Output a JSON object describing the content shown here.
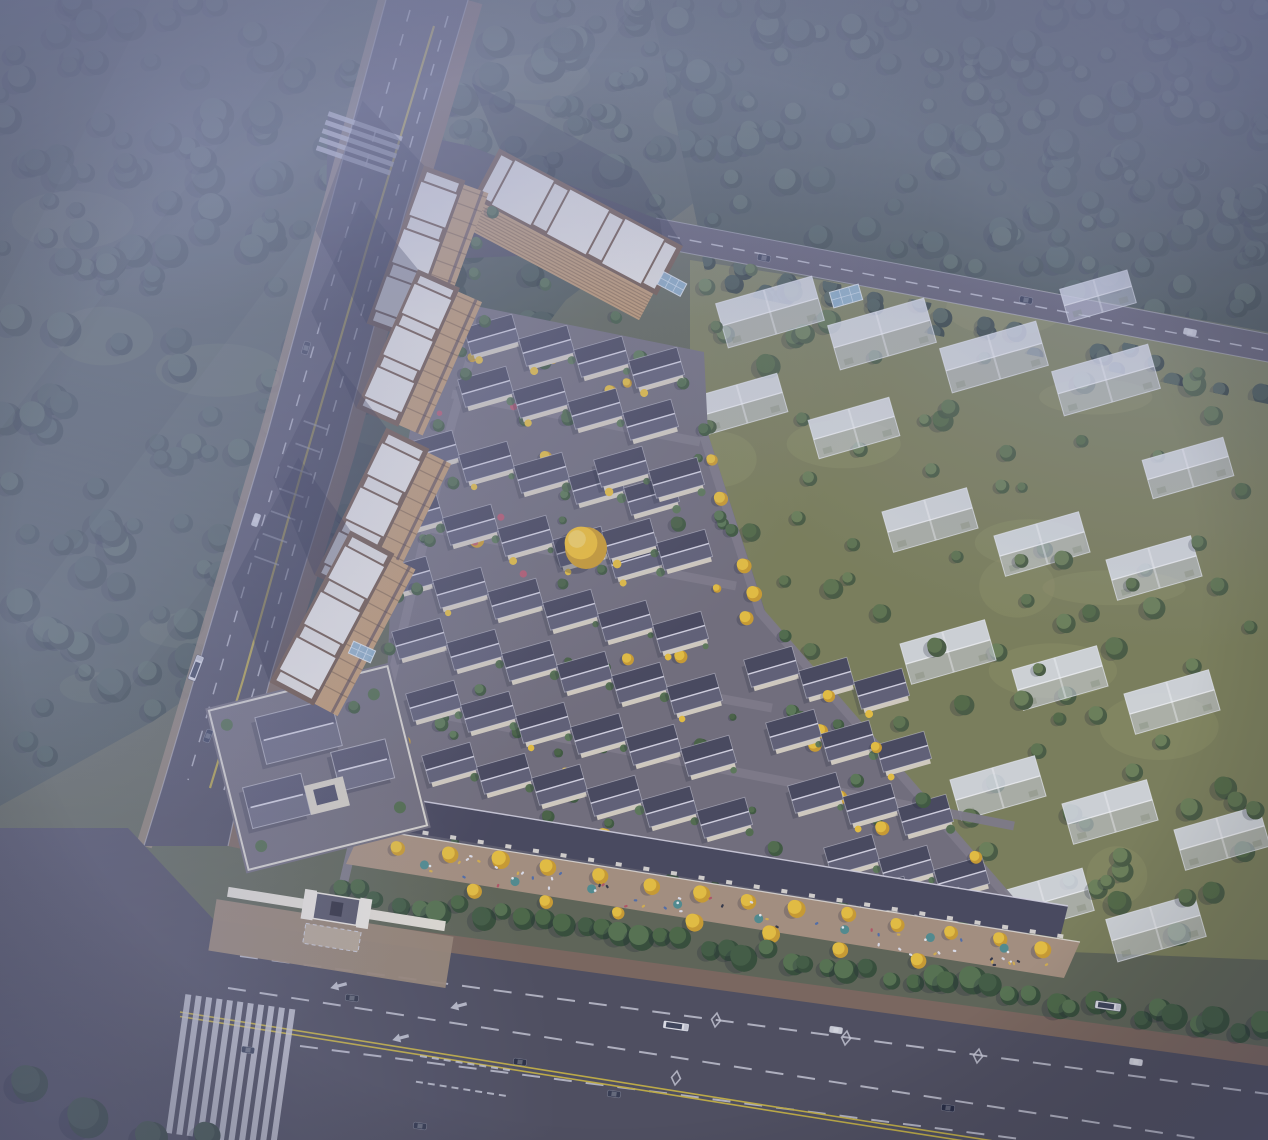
{
  "scene": {
    "canvas": {
      "w": 1268,
      "h": 1140
    },
    "seed": 77,
    "palette": {
      "ground": "#5d6350",
      "grassOlive": "#7b7e54",
      "grassLight": "#8f905f",
      "forestDark": "#32413a",
      "forestMid": "#3e4f45",
      "forestLight": "#4b5d4f",
      "treeGreen": "#4e6a45",
      "treeGreenDk": "#3c5637",
      "hedge": [
        "#3f5a3c",
        "#49663f",
        "#547149"
      ],
      "asphalt": "#4b4a59",
      "asphaltDark": "#45444f",
      "laneWhite": "#cfd0da",
      "laneYellow": "#c3ae3d",
      "sidewalkBrown": "#7b6557",
      "sidewalkTan": "#9a8672",
      "promenade": "#a8907b",
      "villaPaving": "#716d78",
      "pathGray": "#7e7a85",
      "roofDark": "#454457",
      "roofLight": "#5f5e72",
      "ridge": "#d8d6e2",
      "wallCream": "#d9d1c0",
      "towerFacade": "#c49a6a",
      "towerFacadeDk": "#7c5c3c",
      "towerRoof": "#ece9e2",
      "towerParapet": "#6e523e",
      "ghostFill": "rgba(221,224,238,0.52)",
      "ghostRoof": "rgba(238,240,248,0.62)",
      "ghostStroke": "rgba(248,249,253,0.65)",
      "gingko": "#ecc238",
      "gingkoDk": "#d09d27",
      "flowerRed": "#c05468",
      "umbrella": "#4e8c8c",
      "shadow": "rgba(21,24,44,0.36)",
      "fog": "#9aa0c6"
    },
    "forest_regions": [
      {
        "id": "tl",
        "base": "#47534b",
        "poly": [
          [
            0,
            0
          ],
          [
            910,
            0
          ],
          [
            716,
            186
          ],
          [
            566,
            300
          ],
          [
            436,
            468
          ],
          [
            300,
            622
          ],
          [
            152,
            722
          ],
          [
            0,
            806
          ]
        ],
        "count": 250,
        "rmin": 7,
        "rmax": 17
      },
      {
        "id": "ne",
        "base": "#3e4b44",
        "poly": [
          [
            650,
            0
          ],
          [
            1268,
            0
          ],
          [
            1268,
            332
          ],
          [
            698,
            228
          ]
        ],
        "count": 170,
        "rmin": 7,
        "rmax": 15
      },
      {
        "id": "neside",
        "base": "none",
        "poly": [
          [
            702,
            256
          ],
          [
            1268,
            372
          ],
          [
            1268,
            404
          ],
          [
            708,
            288
          ]
        ],
        "count": 30,
        "rmin": 7,
        "rmax": 11
      }
    ],
    "clearings": {
      "count": 9
    },
    "light_beams": [
      [
        [
          150,
          0
        ],
        [
          330,
          0
        ],
        [
          0,
          430
        ],
        [
          0,
          300
        ]
      ],
      [
        [
          480,
          0
        ],
        [
          640,
          0
        ],
        [
          120,
          700
        ],
        [
          20,
          620
        ]
      ]
    ],
    "roads": {
      "left": {
        "left_edge": [
          [
            386,
            0
          ],
          [
            330,
            206
          ],
          [
            268,
            432
          ],
          [
            206,
            640
          ],
          [
            162,
            788
          ],
          [
            144,
            846
          ]
        ],
        "right_edge": [
          [
            468,
            0
          ],
          [
            404,
            216
          ],
          [
            340,
            452
          ],
          [
            272,
            672
          ],
          [
            238,
            800
          ],
          [
            228,
            846
          ]
        ],
        "center_yellow": [
          [
            434,
            26
          ],
          [
            368,
            244
          ],
          [
            302,
            470
          ],
          [
            243,
            680
          ],
          [
            210,
            788
          ]
        ],
        "lanes": [
          [
            [
              410,
              10
            ],
            [
              348,
              228
            ],
            [
              282,
              456
            ],
            [
              222,
              664
            ],
            [
              188,
              780
            ]
          ],
          [
            [
              448,
              16
            ],
            [
              384,
              236
            ],
            [
              318,
              464
            ],
            [
              258,
              676
            ],
            [
              224,
              790
            ]
          ]
        ],
        "crosswalk": {
          "x": 366,
          "y": 124,
          "rot": 19
        },
        "parking": {
          "x": 304,
          "y": 420,
          "rot": 20,
          "n": 7
        }
      },
      "main": {
        "poly": [
          [
            0,
            828
          ],
          [
            128,
            828
          ],
          [
            214,
            920
          ],
          [
            1268,
            1066
          ],
          [
            1268,
            1140
          ],
          [
            0,
            1140
          ]
        ],
        "top_edge": [
          [
            214,
            920
          ],
          [
            1268,
            1064
          ]
        ],
        "lanes": [
          [
            [
              240,
              956
            ],
            [
              1268,
              1094
            ]
          ],
          [
            [
              228,
              988
            ],
            [
              1208,
              1140
            ]
          ],
          [
            [
              300,
              1046
            ],
            [
              1028,
              1140
            ]
          ]
        ],
        "double_yellow": [
          [
            180,
            1014
          ],
          [
            820,
            1116
          ],
          [
            1180,
            1172
          ]
        ],
        "zebra": {
          "x": 184,
          "y": 1004,
          "rot": 8,
          "n": 11
        },
        "gate_cross": {
          "x": 420,
          "y": 1056,
          "rot": 9
        },
        "arrows": [
          [
            338,
            986
          ],
          [
            458,
            1006
          ],
          [
            400,
            1038
          ]
        ],
        "diamonds": [
          [
            716,
            1020
          ],
          [
            846,
            1038
          ],
          [
            978,
            1056
          ],
          [
            676,
            1078
          ]
        ]
      },
      "ne": {
        "poly": [
          [
            656,
            218
          ],
          [
            1268,
            334
          ],
          [
            1268,
            362
          ],
          [
            660,
            248
          ]
        ],
        "center": [
          [
            668,
            236
          ],
          [
            1264,
            350
          ]
        ]
      },
      "junction": [
        [
          328,
          116
        ],
        [
          470,
          146
        ],
        [
          660,
          220
        ],
        [
          664,
          250
        ],
        [
          420,
          260
        ],
        [
          326,
          204
        ]
      ]
    },
    "towers": [
      {
        "cx": 578,
        "cy": 222,
        "len": 208,
        "wid": 56,
        "rot": 28,
        "type": "h"
      },
      {
        "cx": 416,
        "cy": 252,
        "len": 168,
        "wid": 44,
        "rot": 20,
        "type": "v"
      },
      {
        "cx": 408,
        "cy": 348,
        "len": 152,
        "wid": 46,
        "rot": 24,
        "type": "v"
      },
      {
        "cx": 372,
        "cy": 512,
        "len": 164,
        "wid": 48,
        "rot": 26,
        "type": "v"
      },
      {
        "cx": 332,
        "cy": 618,
        "len": 172,
        "wid": 50,
        "rot": 28,
        "type": "v"
      }
    ],
    "villas": {
      "rot": -16,
      "w": 46,
      "h": 27,
      "step": [
        55,
        11
      ],
      "rows": [
        [
          492,
          336,
          4
        ],
        [
          486,
          388,
          4
        ],
        [
          432,
          452,
          5
        ],
        [
          622,
          468,
          2
        ],
        [
          416,
          515,
          5
        ],
        [
          630,
          540,
          2
        ],
        [
          406,
          578,
          6
        ],
        [
          420,
          640,
          6
        ],
        [
          772,
          668,
          3
        ],
        [
          434,
          702,
          6
        ],
        [
          794,
          731,
          3
        ],
        [
          450,
          764,
          6
        ],
        [
          816,
          794,
          3
        ],
        [
          852,
          856,
          3
        ],
        [
          884,
          898,
          2
        ]
      ],
      "poly": [
        [
          446,
          300
        ],
        [
          704,
          352
        ],
        [
          708,
          434
        ],
        [
          766,
          614
        ],
        [
          1026,
          916
        ],
        [
          1030,
          962
        ],
        [
          380,
          832
        ],
        [
          394,
          522
        ],
        [
          422,
          362
        ]
      ],
      "paths": [
        [
          [
            340,
            898
          ],
          [
            400,
            642
          ],
          [
            452,
            422
          ],
          [
            478,
            332
          ]
        ],
        [
          [
            398,
            522
          ],
          [
            736,
            586
          ]
        ],
        [
          [
            412,
            642
          ],
          [
            772,
            708
          ]
        ],
        [
          [
            428,
            712
          ],
          [
            1014,
            826
          ]
        ],
        [
          [
            702,
            430
          ],
          [
            760,
            612
          ],
          [
            1024,
            916
          ]
        ],
        [
          [
            452,
            394
          ],
          [
            700,
            442
          ]
        ]
      ],
      "garden": {
        "green": 72,
        "yellow": 26,
        "red": 12
      }
    },
    "shops": {
      "quad": [
        [
          378,
          794
        ],
        [
          1068,
          906
        ],
        [
          1060,
          938
        ],
        [
          370,
          826
        ]
      ],
      "ticks": 26
    },
    "promenade": {
      "quad": [
        [
          362,
          828
        ],
        [
          1080,
          942
        ],
        [
          1064,
          978
        ],
        [
          346,
          864
        ]
      ],
      "tree_rows": [
        {
          "line": [
            [
              400,
              846
            ],
            [
              1046,
              948
            ]
          ],
          "n": 14
        },
        {
          "line": [
            [
              470,
              888
            ],
            [
              916,
              960
            ]
          ],
          "n": 7
        }
      ],
      "people": {
        "line": [
          [
            382,
            856
          ],
          [
            1052,
            962
          ]
        ],
        "n": 48
      },
      "umbrellas": {
        "line": [
          [
            430,
            866
          ],
          [
            1008,
            952
          ]
        ],
        "n": 8
      }
    },
    "hedge": {
      "line": [
        [
          336,
          890
        ],
        [
          1260,
          1030
        ]
      ],
      "n": 46
    },
    "ghost": {
      "poly": [
        [
          690,
          260
        ],
        [
          1268,
          348
        ],
        [
          1268,
          960
        ],
        [
          1022,
          950
        ],
        [
          764,
          612
        ],
        [
          690,
          424
        ]
      ],
      "rot": -16,
      "buildings": [
        [
          770,
          312,
          100,
          46
        ],
        [
          882,
          334,
          100,
          46
        ],
        [
          994,
          357,
          100,
          46
        ],
        [
          1106,
          380,
          100,
          46
        ],
        [
          742,
          404,
          84,
          40
        ],
        [
          854,
          428,
          84,
          40
        ],
        [
          1098,
          296,
          70,
          34
        ],
        [
          1188,
          468,
          84,
          40
        ],
        [
          930,
          520,
          88,
          42
        ],
        [
          1042,
          544,
          88,
          42
        ],
        [
          1154,
          568,
          88,
          42
        ],
        [
          948,
          652,
          88,
          42
        ],
        [
          1060,
          678,
          88,
          42
        ],
        [
          1172,
          702,
          88,
          42
        ],
        [
          998,
          788,
          88,
          42
        ],
        [
          1110,
          812,
          88,
          42
        ],
        [
          1222,
          838,
          88,
          42
        ],
        [
          1044,
          902,
          92,
          44
        ],
        [
          1156,
          928,
          92,
          44
        ]
      ],
      "trees_under": 55,
      "trees_over": 30,
      "patches": 10
    },
    "boundary_gingkos": {
      "line": [
        [
          702,
          430
        ],
        [
          760,
          612
        ],
        [
          1020,
          912
        ]
      ],
      "n": 12
    },
    "clubhouse": {
      "cx": 318,
      "cy": 768,
      "rot": -14
    },
    "gate": {
      "cx": 336,
      "cy": 912,
      "rot": 9
    },
    "canopies": [
      [
        672,
        284,
        26,
        14,
        28
      ],
      [
        362,
        652,
        24,
        13,
        24
      ],
      [
        846,
        296,
        30,
        16,
        -16
      ]
    ],
    "golden_tree": {
      "x": 584,
      "y": 546,
      "r": 21
    },
    "corner_trees": [
      [
        28,
        1082,
        18
      ],
      [
        86,
        1116,
        20
      ],
      [
        150,
        1136,
        16
      ],
      [
        206,
        1134,
        13
      ]
    ],
    "vehicles": {
      "left_road": [
        {
          "x": 306,
          "y": 348,
          "rot": -73,
          "c": "#2e3344",
          "t": "car"
        },
        {
          "x": 256,
          "y": 520,
          "rot": -71,
          "c": "#d6d7de",
          "t": "car"
        },
        {
          "x": 196,
          "y": 668,
          "rot": -69,
          "t": "bus"
        },
        {
          "x": 208,
          "y": 736,
          "rot": -69,
          "c": "#333a52",
          "t": "car"
        }
      ],
      "main_road": [
        {
          "x": 352,
          "y": 998,
          "rot": 8,
          "c": "#2b3040",
          "t": "car"
        },
        {
          "x": 520,
          "y": 1062,
          "rot": 8,
          "c": "#23273a",
          "t": "car"
        },
        {
          "x": 614,
          "y": 1094,
          "rot": 8,
          "c": "#31364a",
          "t": "car"
        },
        {
          "x": 836,
          "y": 1030,
          "rot": 8,
          "c": "#cfd0d6",
          "t": "car"
        },
        {
          "x": 948,
          "y": 1108,
          "rot": 8,
          "c": "#20243a",
          "t": "car"
        },
        {
          "x": 1136,
          "y": 1062,
          "rot": 8,
          "c": "#d8d9df",
          "t": "car"
        },
        {
          "x": 676,
          "y": 1026,
          "rot": 8,
          "t": "bus"
        },
        {
          "x": 1108,
          "y": 1006,
          "rot": 8,
          "t": "bus"
        },
        {
          "x": 248,
          "y": 1050,
          "rot": 8,
          "c": "#3a4156",
          "t": "car"
        },
        {
          "x": 420,
          "y": 1126,
          "rot": 8,
          "c": "#2d3246",
          "t": "car"
        }
      ],
      "ne_road": [
        {
          "x": 764,
          "y": 258,
          "rot": 11,
          "c": "#2e3246",
          "t": "car"
        },
        {
          "x": 1026,
          "y": 300,
          "rot": 11,
          "c": "#23283c",
          "t": "car"
        },
        {
          "x": 1190,
          "y": 332,
          "rot": 11,
          "c": "#d4d5dc",
          "t": "car"
        }
      ]
    },
    "fog": {
      "tl": {
        "cx": 0.14,
        "cy": 0.12,
        "r": 0.6,
        "opacity": 0.62
      },
      "top": {
        "height": 320,
        "opacity": 0.5
      },
      "tr": {
        "cx": 0.93,
        "cy": 0.07,
        "r": 0.5,
        "opacity": 0.55
      },
      "left": {
        "cx": 0.01,
        "cy": 0.55,
        "r": 0.42,
        "opacity": 0.4
      },
      "bl": {
        "cx": 0.04,
        "cy": 0.97,
        "r": 0.4,
        "opacity": 0.32
      },
      "tint": {
        "color": "#767bad",
        "opacity": 0.1
      },
      "vignette": {
        "color": "rgba(54,58,92,0.34)"
      }
    }
  }
}
